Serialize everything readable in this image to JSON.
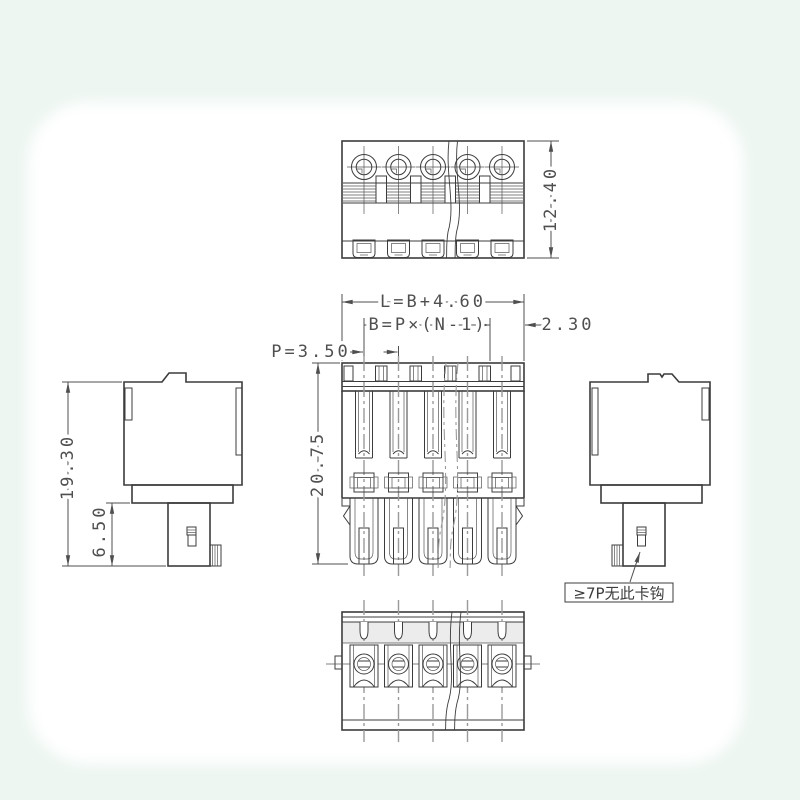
{
  "drawing": {
    "poles_shown": 5
  },
  "dims": {
    "top_height": "12.40",
    "length_formula": "L=B+4.60",
    "span_formula": "B=P×(N-1)",
    "end_offset": "2.30",
    "pitch": "P=3.50",
    "front_height": "20.75",
    "side_height": "19.30",
    "plug_depth": "6.50"
  },
  "note": {
    "text": "≥7P无此卡钩"
  },
  "colors": {
    "line": "#3c3c3c",
    "thin": "#555555",
    "centerline": "#9a9a9a",
    "dim": "#4f4f4f",
    "paper": "#ffffff",
    "tint": "#edf6f1"
  }
}
